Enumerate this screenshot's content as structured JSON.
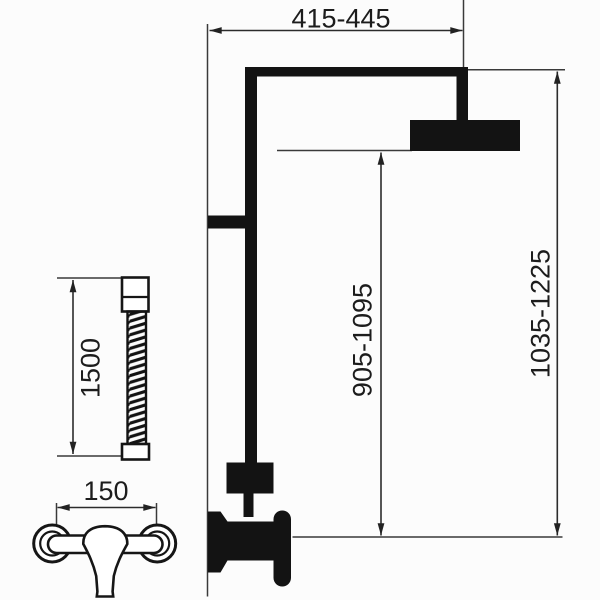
{
  "diagram": {
    "kind": "technical-dimension-drawing",
    "dimension_labels": {
      "top_width": "415-445",
      "total_height": "1035-1225",
      "head_height": "905-1095",
      "hose_length": "1500",
      "mixer_spacing": "150"
    },
    "colors": {
      "background": "#fcfcfc",
      "line": "#3a3a3a",
      "solid": "#131313",
      "text": "#1c1c1c"
    }
  }
}
